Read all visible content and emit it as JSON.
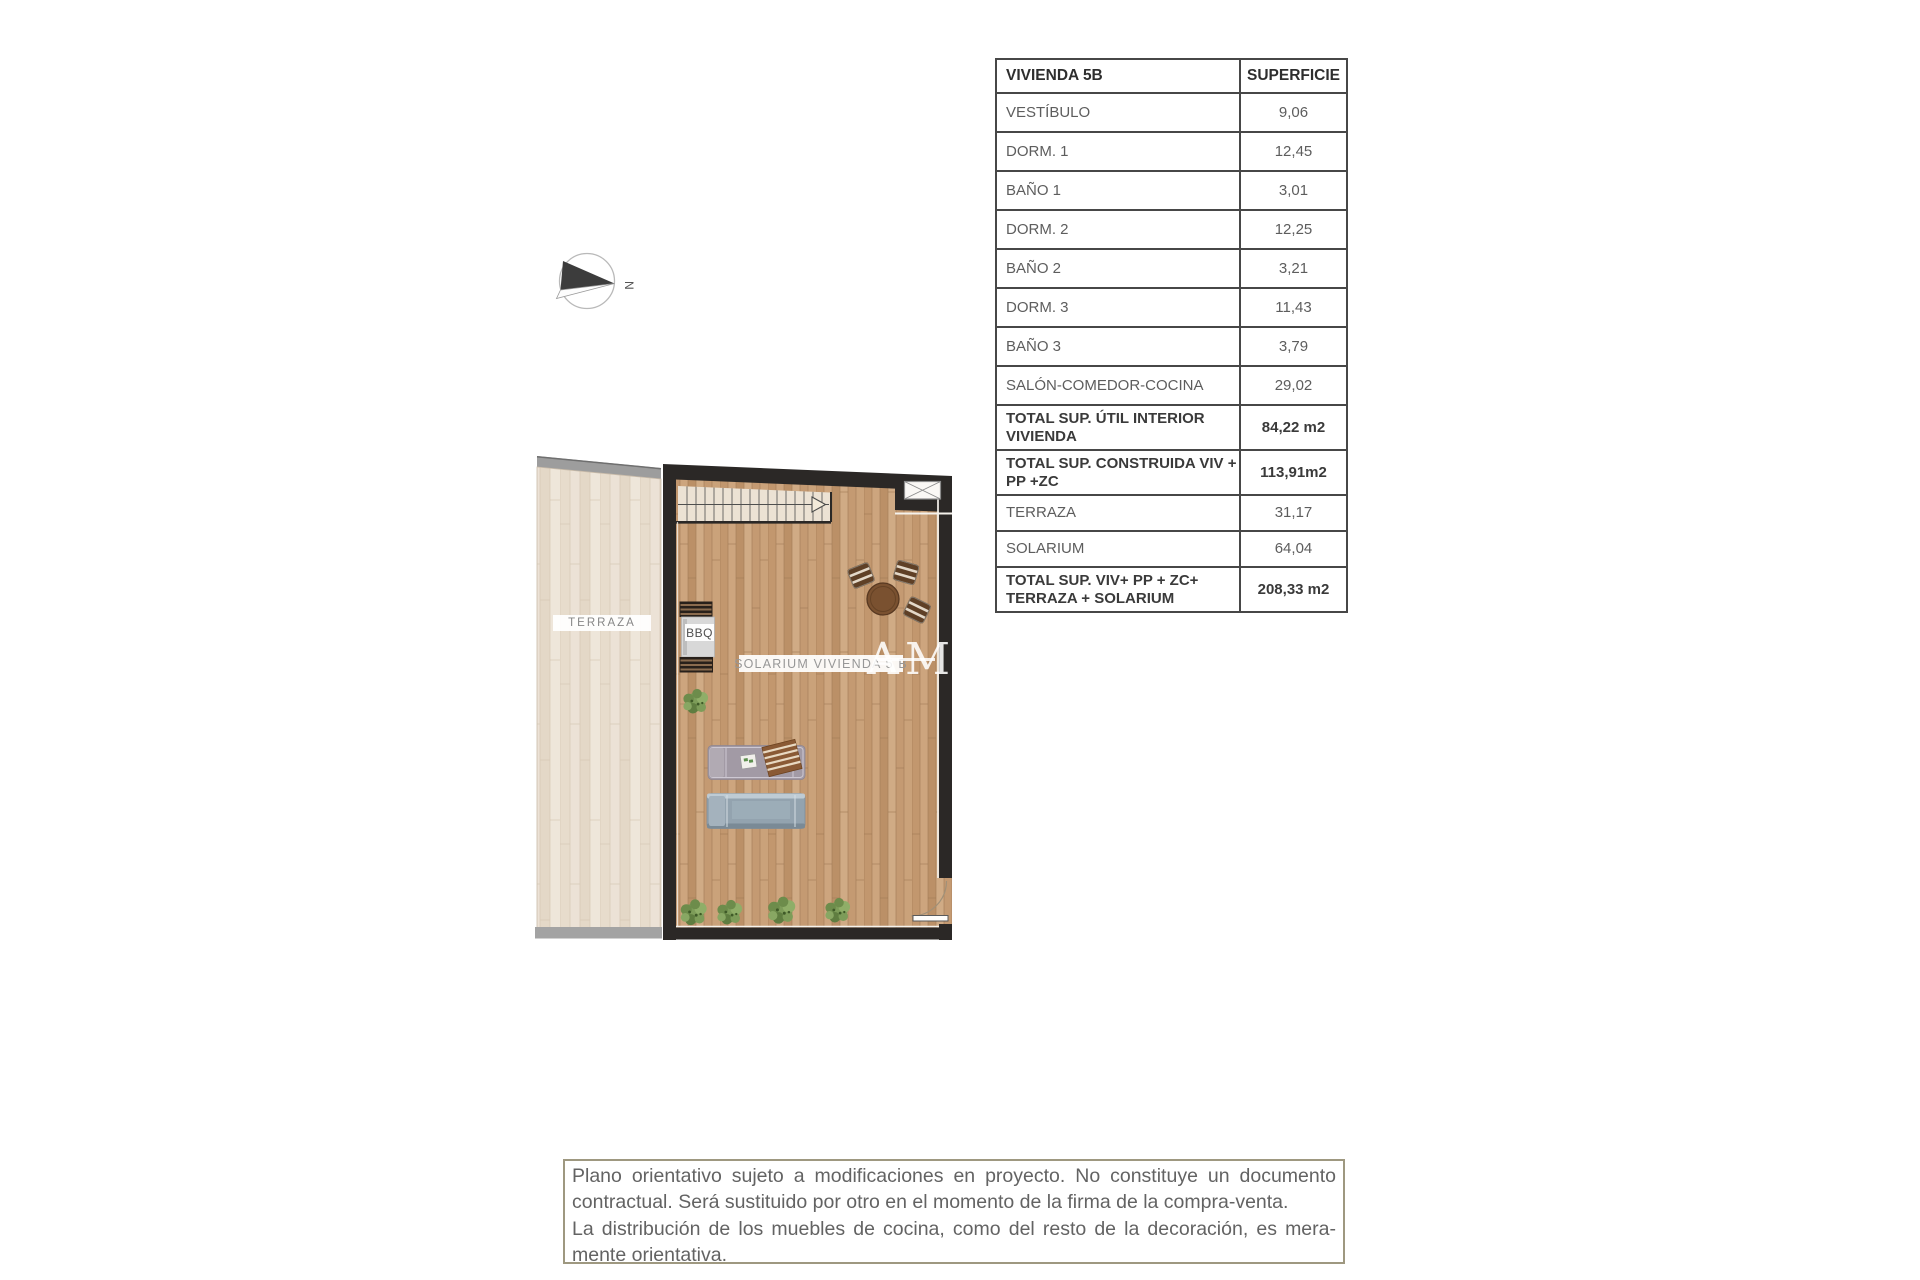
{
  "table": {
    "header": {
      "col1": "VIVIENDA 5B",
      "col2": "SUPERFICIE"
    },
    "rows": [
      {
        "label": "VESTÍBULO",
        "value": "9,06"
      },
      {
        "label": "DORM. 1",
        "value": "12,45"
      },
      {
        "label": "BAÑO 1",
        "value": "3,01"
      },
      {
        "label": "DORM. 2",
        "value": "12,25"
      },
      {
        "label": "BAÑO 2",
        "value": "3,21"
      },
      {
        "label": "DORM. 3",
        "value": "11,43"
      },
      {
        "label": "BAÑO 3",
        "value": "3,79"
      },
      {
        "label": "SALÓN-COMEDOR-COCINA",
        "value": "29,02"
      },
      {
        "label": "TOTAL SUP. ÚTIL INTERIOR VIVIENDA",
        "value": "84,22 m2"
      },
      {
        "label": "TOTAL SUP. CONSTRUIDA VIV + PP +ZC",
        "value": "113,91m2"
      },
      {
        "label": "TERRAZA",
        "value": "31,17"
      },
      {
        "label": "SOLARIUM",
        "value": "64,04"
      },
      {
        "label": "TOTAL SUP. VIV+ PP + ZC+ TERRAZA + SOLARIUM",
        "value": "208,33 m2"
      }
    ]
  },
  "plan": {
    "terraza_label": "TERRAZA",
    "solarium_label": "SOLARIUM VIVIENDA 5 B",
    "bbq_label": "BBQ",
    "compass_n": "N",
    "watermark_a": "A",
    "watermark_m": "M"
  },
  "disclaimer": {
    "lines": [
      "Plano orientativo sujeto a modificaciones en proyecto. No constituye un documento",
      "contractual. Será sustituido por otro en el momento de la firma de la compra-venta.",
      "La distribución de los muebles de cocina, como del resto de la decoración, es mera-",
      "mente orientativa."
    ]
  },
  "colors": {
    "wall": "#2b2826",
    "wood_solarium": "#c79f79",
    "wood_terrace": "#eadfd2",
    "table_border": "#474747",
    "disclaimer_border": "#9e9880"
  }
}
